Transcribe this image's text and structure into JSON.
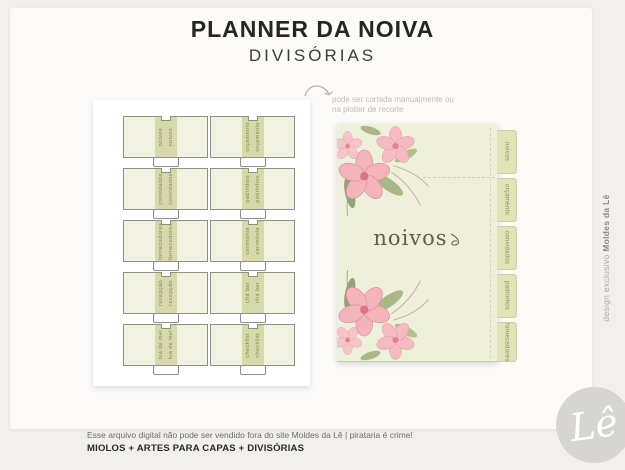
{
  "header": {
    "title": "PLANNER DA NOIVA",
    "subtitle": "DIVISÓRIAS"
  },
  "annotation": {
    "line1": "pode ser cortada manualmente ou",
    "line2": "na plotter de recorte"
  },
  "left_sheet": {
    "dividers": [
      {
        "label": "noivos"
      },
      {
        "label": "orçamento"
      },
      {
        "label": "convidados"
      },
      {
        "label": "padrinhos"
      },
      {
        "label": "fornecedores"
      },
      {
        "label": "cerimônia"
      },
      {
        "label": "recepção"
      },
      {
        "label": "chá bar"
      },
      {
        "label": "lua de mel"
      },
      {
        "label": "checklist"
      }
    ]
  },
  "right_page": {
    "center_label": "noivos",
    "tabs": [
      {
        "label": "noivos"
      },
      {
        "label": "orçamento"
      },
      {
        "label": "convidados"
      },
      {
        "label": "padrinhos"
      },
      {
        "label": "fornecedores"
      }
    ]
  },
  "footer": {
    "line1": "Esse arquivo digital não pode ser vendido fora do site Moldes da Lê  |  pirataria é crime!",
    "line2": "MIOLOS + ARTES PARA CAPAS + DIVISÓRIAS"
  },
  "side_note": {
    "regular": "design exclusivo ",
    "bold": "Moldes da Lê"
  },
  "logo": {
    "monogram": "Lê"
  },
  "colors": {
    "page_fill": "#eef0dc",
    "band_fill": "#d8d9aa",
    "tab_fill": "#e1e3b8",
    "petal_pink": "#f4bcc2",
    "olive_text": "#8c8c60"
  }
}
